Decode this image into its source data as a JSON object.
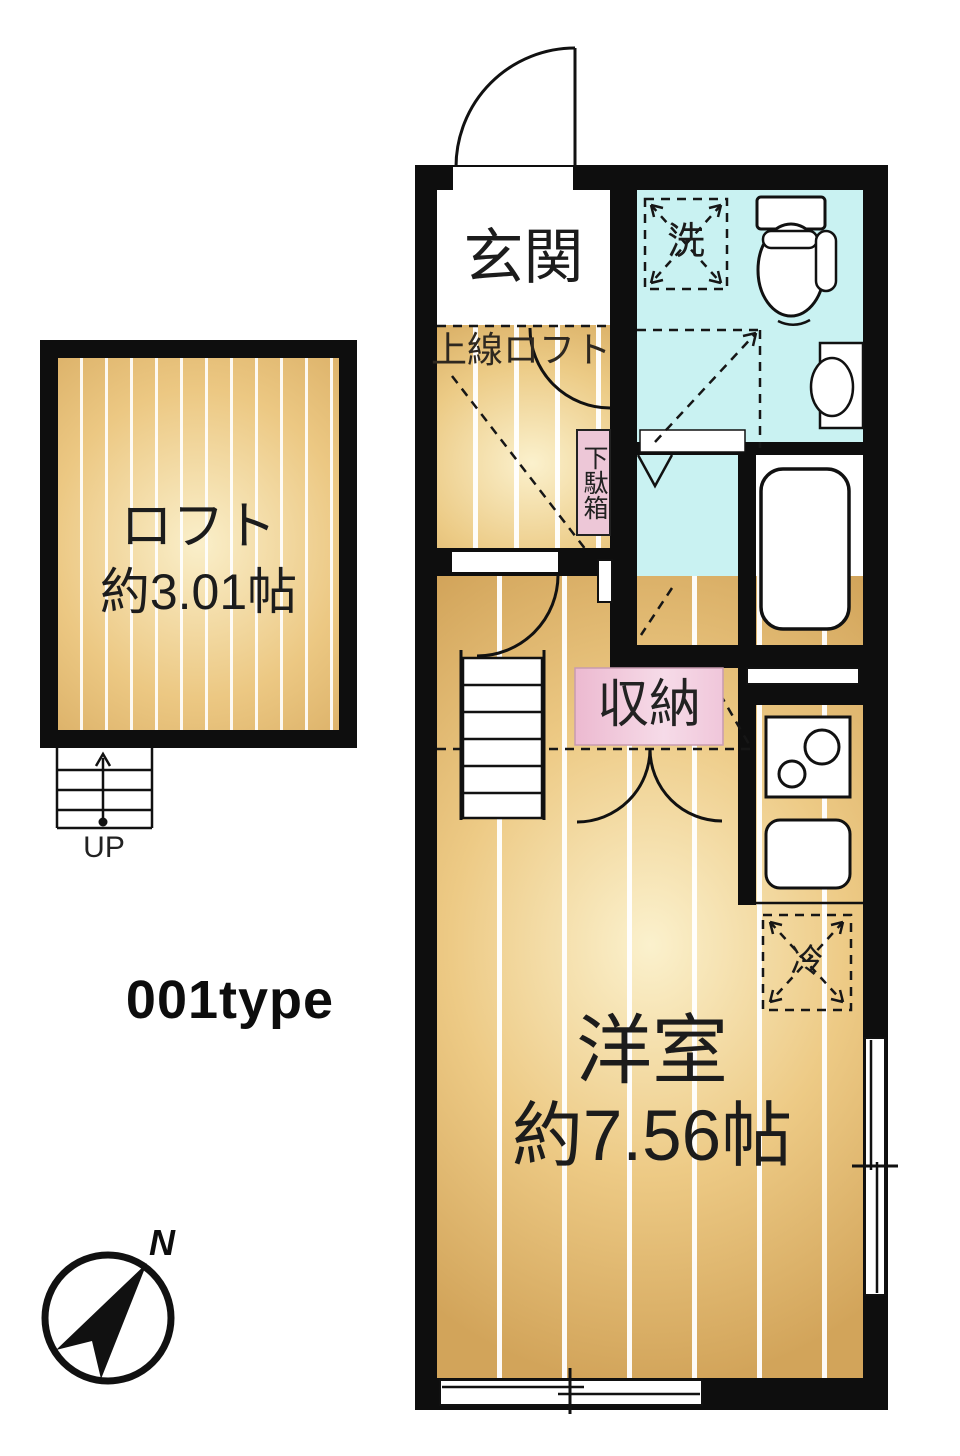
{
  "labels": {
    "entrance": "玄関",
    "loft_overhead_note": "上線ロフト",
    "washing_machine": "洗",
    "shoe_cabinet": "下駄箱",
    "storage": "収納",
    "refrigerator": "冷",
    "western_room_name": "洋室",
    "western_room_size": "約7.56帖",
    "loft_name": "ロフト",
    "loft_size": "約3.01帖",
    "stairs_up": "UP",
    "plan_type": "001type",
    "compass_north": "N"
  },
  "colors": {
    "wall": "#0e0e0e",
    "wood_floor": "#e7c47f",
    "wet_area": "#c9f2f2",
    "storage_pink": "#f2cadb",
    "background": "#ffffff"
  }
}
